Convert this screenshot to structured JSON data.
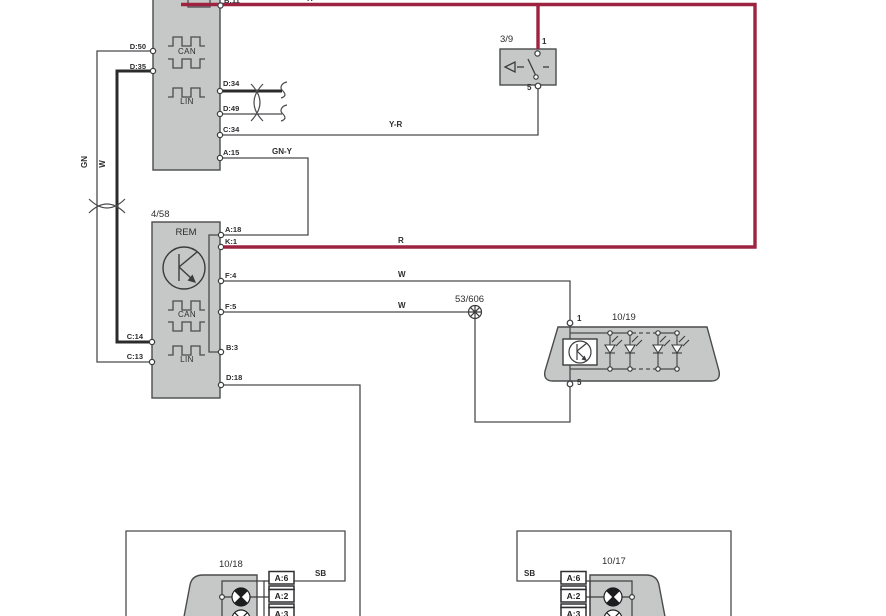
{
  "colors": {
    "red_wire": "#9e2340",
    "wire": "#4a4b4d",
    "thick_wire": "#2b2b2b",
    "block_fill": "#c6c7c7",
    "block_border": "#4a4b4d"
  },
  "ecu_top": {
    "pin_b11": "B:11",
    "bus1": "CAN",
    "bus2": "LIN",
    "left_pins": {
      "p1": "D:50",
      "p2": "D:35"
    },
    "right_pins": {
      "p1": "D:34",
      "p2": "D:49",
      "p3": "C:34",
      "p4": "A:15"
    }
  },
  "rem": {
    "ref": "4/58",
    "name": "REM",
    "bus1": "CAN",
    "bus2": "LIN",
    "right_pins": {
      "a18": "A:18",
      "k1": "K:1",
      "f4": "F:4",
      "f5": "F:5",
      "b3": "B:3",
      "d18": "D:18"
    },
    "left_pins": {
      "c14": "C:14",
      "c13": "C:13"
    }
  },
  "switch39": {
    "ref": "3/9",
    "pin_top": "1",
    "pin_bottom": "5"
  },
  "splice": {
    "ref": "53/606"
  },
  "led_unit": {
    "ref": "10/19",
    "pin_top": "1",
    "pin_bottom": "5"
  },
  "lamp_left": {
    "ref": "10/18",
    "pin1": "A:6",
    "pin2": "A:2",
    "pin3": "A:3"
  },
  "lamp_right": {
    "ref": "10/17",
    "pin1": "A:6",
    "pin2": "A:2",
    "pin3": "A:3"
  },
  "wire_labels": {
    "r_top": "R",
    "r_k1": "R",
    "y_r": "Y-R",
    "gn_y": "GN-Y",
    "w_f4": "W",
    "w_f5": "W",
    "gn_vert": "GN",
    "w_vert": "W",
    "sb_left": "SB",
    "sb_right": "SB"
  }
}
